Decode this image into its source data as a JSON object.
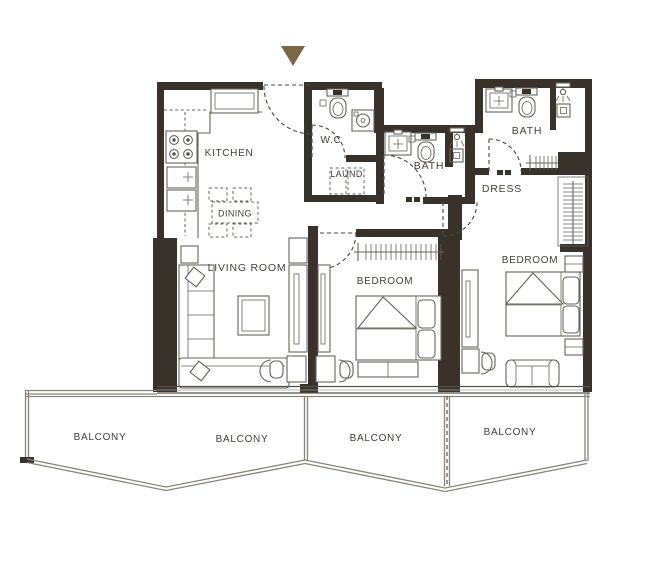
{
  "rooms": {
    "kitchen": "KITCHEN",
    "dining": "DINING",
    "living_room": "LIVING ROOM",
    "wc": "W.C",
    "laundry": "LAUND.",
    "bath_1": "BATH",
    "bath_2": "BATH",
    "dress": "DRESS",
    "bedroom_1": "BEDROOM",
    "bedroom_2": "BEDROOM"
  },
  "balconies": [
    "BALCONY",
    "BALCONY",
    "BALCONY",
    "BALCONY"
  ],
  "colors": {
    "wall": "#38322a",
    "furniture_line": "#68635a",
    "door_line": "#4b453c",
    "rail": "#8a857c",
    "text": "#45403a",
    "entrance_arrow": "#7b6747",
    "background": "#ffffff"
  }
}
